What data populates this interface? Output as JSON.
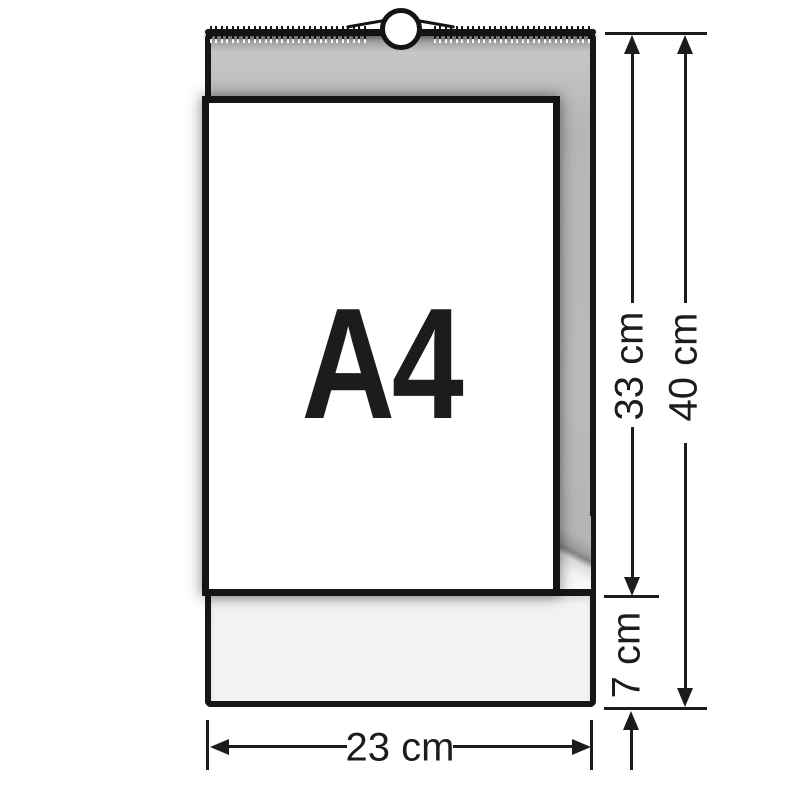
{
  "diagram": {
    "page_label": "A4",
    "dimensions": {
      "sheet_height": "33 cm",
      "total_height": "40 cm",
      "footer_height": "7 cm",
      "width": "23 cm"
    },
    "colors": {
      "ink": "#1c1c1c",
      "board_gray": "#b8b8b8",
      "footer_gray": "#f3f3f3",
      "page_white": "#ffffff"
    }
  }
}
